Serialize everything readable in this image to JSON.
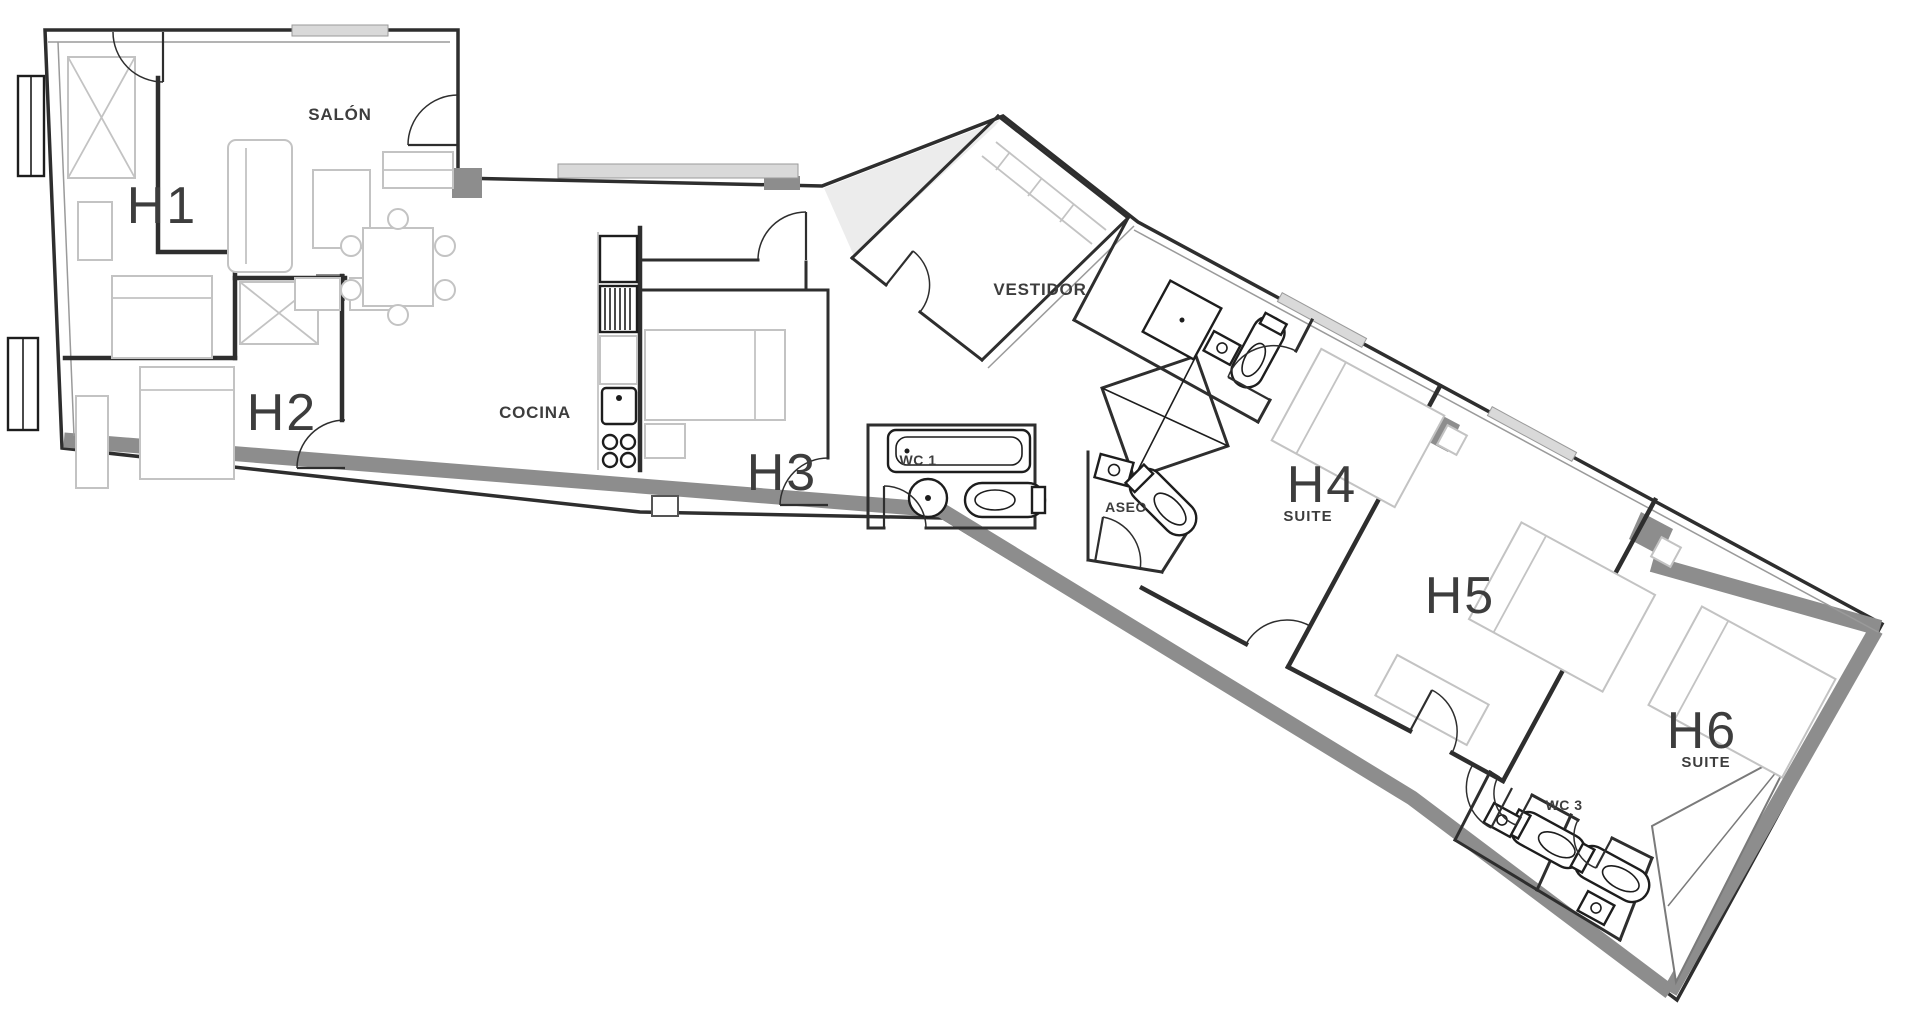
{
  "plan": {
    "type": "apartment-floor-plan",
    "rooms": [
      {
        "id": "h1",
        "label": "H1"
      },
      {
        "id": "salon",
        "label": "SALÓN"
      },
      {
        "id": "h2",
        "label": "H2"
      },
      {
        "id": "cocina",
        "label": "COCINA"
      },
      {
        "id": "h3",
        "label": "H3"
      },
      {
        "id": "wc1",
        "label": "WC 1"
      },
      {
        "id": "vestidor",
        "label": "VESTIDOR"
      },
      {
        "id": "aseo",
        "label": "ASEO"
      },
      {
        "id": "h4",
        "label": "H4"
      },
      {
        "id": "h4-suite",
        "label": "SUITE"
      },
      {
        "id": "h5",
        "label": "H5"
      },
      {
        "id": "h6",
        "label": "H6"
      },
      {
        "id": "h6-suite",
        "label": "SUITE"
      },
      {
        "id": "wc3",
        "label": "WC 3"
      }
    ],
    "colors": {
      "background": "#ffffff",
      "wall": "#2e2e2e",
      "wall_light": "#9a9a9a",
      "exterior_band": "#8d8d8d",
      "furniture": "#c3c3c3",
      "fixture": "#1d1d1d",
      "label": "#3d3d3d",
      "window": "#d9d9d9"
    },
    "icons": {
      "toilet": "pill-with-bowl",
      "sink": "square-with-basin",
      "bathtub": "rounded-rect",
      "shower": "square-with-drain",
      "stove": "four-burner-circles",
      "door": "quarter-arc",
      "shaft": "crossed-box",
      "wardrobe": "crossed-box"
    }
  }
}
